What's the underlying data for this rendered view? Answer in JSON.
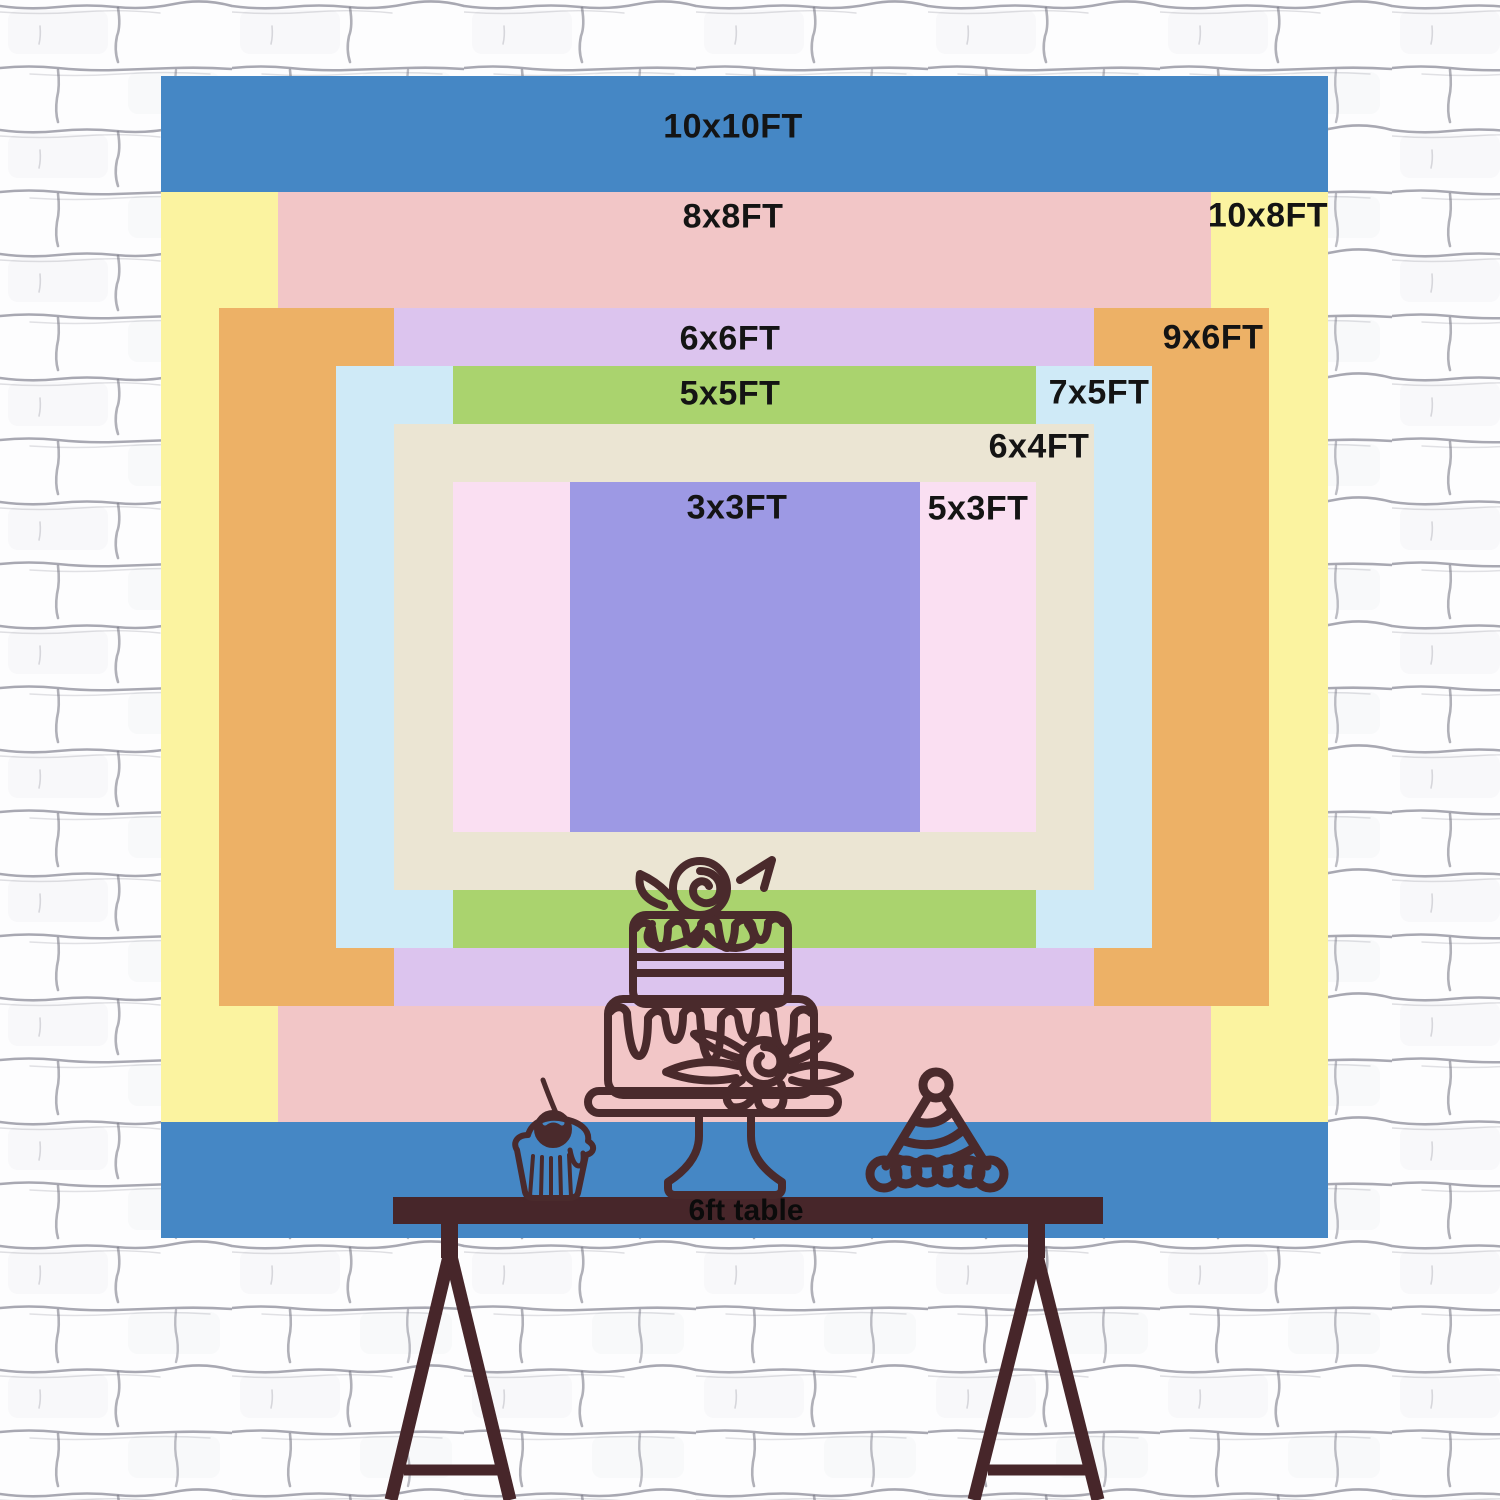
{
  "scene": {
    "wall_color": "#fdfdfe",
    "mortar_color": "#70707e",
    "description": "backdrop size chart on white brick wall"
  },
  "backdrop": {
    "label_color": "#141414",
    "layers": [
      {
        "id": "10x10",
        "label": "10x10FT",
        "width_ft": 10,
        "height_ft": 10,
        "color": "#4587c5",
        "x": 161,
        "y": 76,
        "w": 1167,
        "h": 1162,
        "label_x": 733,
        "label_y": 127
      },
      {
        "id": "10x8",
        "label": "10x8FT",
        "width_ft": 10,
        "height_ft": 8,
        "color": "#fbf3a0",
        "x": 161,
        "y": 192,
        "w": 1167,
        "h": 930,
        "label_x": 1268,
        "label_y": 216
      },
      {
        "id": "8x8",
        "label": "8x8FT",
        "width_ft": 8,
        "height_ft": 8,
        "color": "#f2c6c7",
        "x": 278,
        "y": 192,
        "w": 933,
        "h": 930,
        "label_x": 733,
        "label_y": 217
      },
      {
        "id": "9x6",
        "label": "9x6FT",
        "width_ft": 9,
        "height_ft": 6,
        "color": "#edb166",
        "x": 219,
        "y": 308,
        "w": 1050,
        "h": 698,
        "label_x": 1213,
        "label_y": 338
      },
      {
        "id": "6x6",
        "label": "6x6FT",
        "width_ft": 6,
        "height_ft": 6,
        "color": "#dcc4ee",
        "x": 394,
        "y": 308,
        "w": 700,
        "h": 698,
        "label_x": 730,
        "label_y": 339
      },
      {
        "id": "7x5",
        "label": "7x5FT",
        "width_ft": 7,
        "height_ft": 5,
        "color": "#cfeaf7",
        "x": 336,
        "y": 366,
        "w": 816,
        "h": 582,
        "label_x": 1099,
        "label_y": 393
      },
      {
        "id": "5x5",
        "label": "5x5FT",
        "width_ft": 5,
        "height_ft": 5,
        "color": "#aad36e",
        "x": 453,
        "y": 366,
        "w": 583,
        "h": 582,
        "label_x": 730,
        "label_y": 394
      },
      {
        "id": "6x4",
        "label": "6x4FT",
        "width_ft": 6,
        "height_ft": 4,
        "color": "#ebe5d3",
        "x": 394,
        "y": 424,
        "w": 700,
        "h": 466,
        "label_x": 1039,
        "label_y": 447
      },
      {
        "id": "5x3",
        "label": "5x3FT",
        "width_ft": 5,
        "height_ft": 3,
        "color": "#fadff2",
        "x": 453,
        "y": 482,
        "w": 583,
        "h": 350,
        "label_x": 978,
        "label_y": 509
      },
      {
        "id": "3x3",
        "label": "3x3FT",
        "width_ft": 3,
        "height_ft": 3,
        "color": "#9d99e4",
        "x": 570,
        "y": 482,
        "w": 350,
        "h": 350,
        "label_x": 737,
        "label_y": 508
      }
    ]
  },
  "table": {
    "label": "6ft table",
    "color": "#47262a",
    "label_x": 746,
    "label_y": 1211
  },
  "artwork": {
    "line_color": "#4a2a2c",
    "cherry_highlight_color": "#4587c5",
    "items": [
      "birthday-cake-illustration",
      "cupcake-illustration",
      "party-hat-illustration",
      "trestle-table-illustration"
    ]
  }
}
